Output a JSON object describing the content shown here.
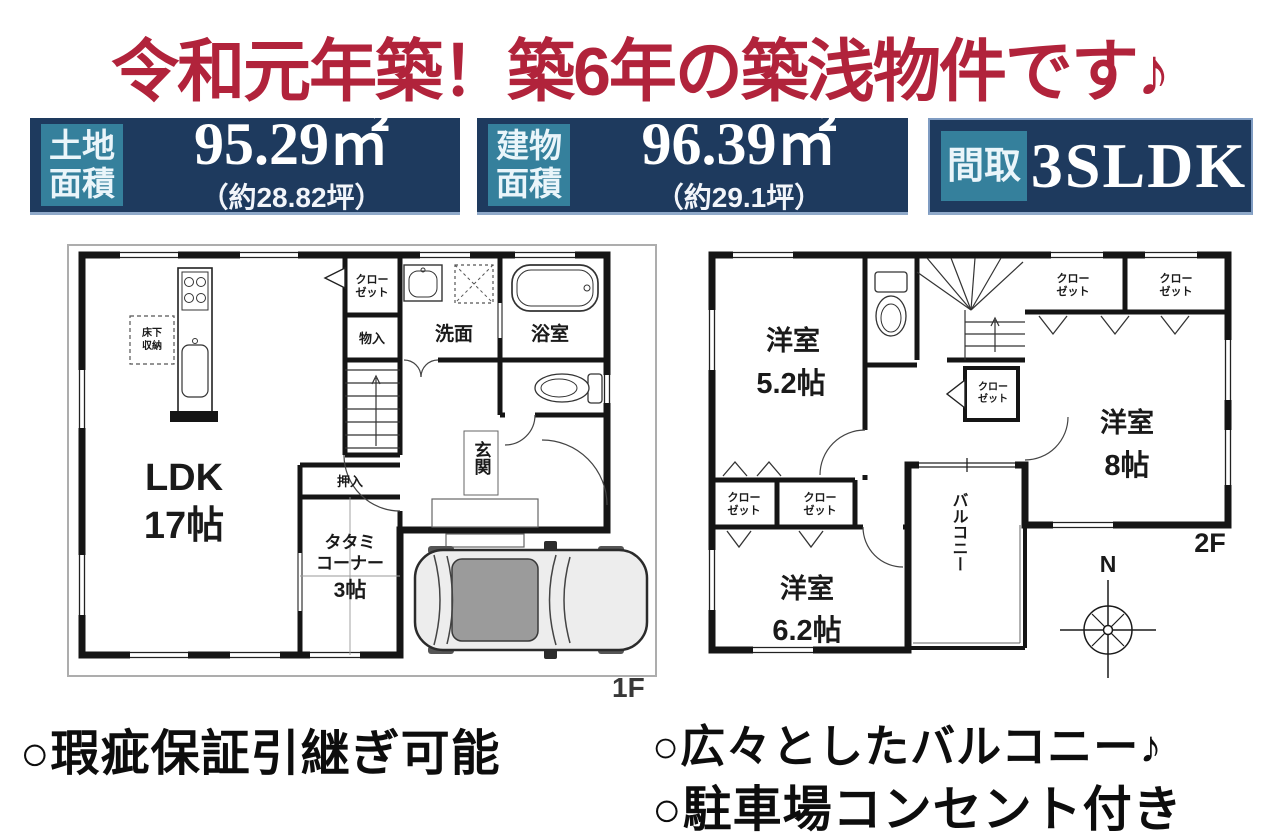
{
  "headline": {
    "text": "令和元年築！築6年の築浅物件です♪",
    "color": "#b1233b"
  },
  "info_boxes": [
    {
      "label_line1": "土地",
      "label_line2": "面積",
      "value": "95.29㎡",
      "sub": "（約28.82坪）"
    },
    {
      "label_line1": "建物",
      "label_line2": "面積",
      "value": "96.39㎡",
      "sub": "（約29.1坪）"
    },
    {
      "label": "間取",
      "value": "3SLDK"
    }
  ],
  "colors": {
    "accent_red": "#b1233b",
    "navy": "#1e3a5e",
    "teal": "#35809c",
    "wall": "#151515"
  },
  "floor1": {
    "floor_label": "1F",
    "rooms": {
      "ldk": [
        "LDK",
        "17帖"
      ],
      "tatami": [
        "タタミ",
        "コーナー",
        "3帖"
      ],
      "closet": [
        "クロー",
        "ゼット"
      ],
      "storage": "物入",
      "washroom": "洗面",
      "bathroom": "浴室",
      "entrance": "玄関",
      "oshiire": "押入",
      "underfloor": [
        "床下",
        "収納"
      ]
    }
  },
  "floor2": {
    "floor_label": "2F",
    "compass_n": "N",
    "rooms": {
      "western1": [
        "洋室",
        "5.2帖"
      ],
      "western2": [
        "洋室",
        "8帖"
      ],
      "western3": [
        "洋室",
        "6.2帖"
      ],
      "closet": [
        "クロー",
        "ゼット"
      ],
      "balcony": "バルコニー"
    }
  },
  "features": [
    "○瑕疵保証引継ぎ可能",
    "○広々としたバルコニー♪",
    "○駐車場コンセント付き"
  ]
}
